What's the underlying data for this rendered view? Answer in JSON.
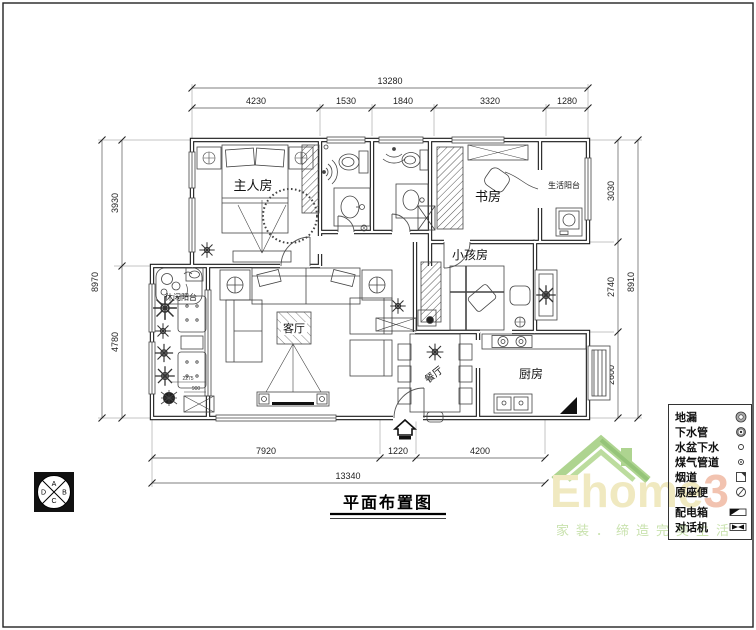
{
  "title": "平面布置图",
  "rooms": {
    "master": "主人房",
    "study": "书房",
    "life_balcony": "生活阳台",
    "kids": "小孩房",
    "leisure_balcony": "休闲阳台",
    "living": "客厅",
    "dining": "餐厅",
    "kitchen": "厨房"
  },
  "dimensions": {
    "top": {
      "overall": "13280",
      "segments": [
        "4230",
        "1530",
        "1840",
        "3320",
        "1280"
      ]
    },
    "left": {
      "overall": "8970",
      "segments": [
        "3930",
        "4780"
      ]
    },
    "right": {
      "overall": "8910",
      "segments": [
        "3030",
        "2740",
        "2600"
      ]
    },
    "bottom": {
      "overall": "13340",
      "segments": [
        "7920",
        "1220",
        "4200"
      ]
    },
    "balcony_small": [
      "2275",
      "900"
    ]
  },
  "legend": {
    "items": [
      {
        "label": "地漏",
        "symbol": "double-circle"
      },
      {
        "label": "下水管",
        "symbol": "ringed-circle"
      },
      {
        "label": "水盆下水",
        "symbol": "small-circle"
      },
      {
        "label": "煤气管道",
        "symbol": "dotted-circle"
      },
      {
        "label": "烟道",
        "symbol": "notched-square"
      },
      {
        "label": "原座便",
        "symbol": "slashed-circle"
      },
      {
        "label": "配电箱",
        "symbol": "half-filled-rect"
      },
      {
        "label": "对话机",
        "symbol": "bowtie-rect"
      }
    ]
  },
  "elevation_marker": {
    "letters": [
      "A",
      "B",
      "C",
      "D"
    ]
  },
  "watermark": {
    "brand": "Ehome",
    "suffix": "3",
    "tagline": "家装．缔造完美生活"
  },
  "colors": {
    "line": "#333333",
    "roof_green": "#aed490",
    "brand_yellow": "#f0e9c0",
    "brand_red": "#f2c3b0",
    "tagline_green": "#c9e2ae"
  }
}
